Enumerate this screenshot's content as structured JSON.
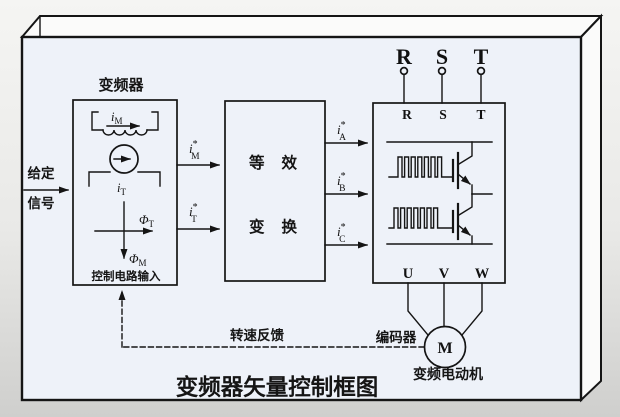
{
  "diagram_title": "变频器矢量控制框图",
  "colors": {
    "line": "#151515",
    "panel_fill": "#eef2f9",
    "face_fill": "#fbfbfa"
  },
  "input": {
    "line1": "给定",
    "line2": "信号"
  },
  "converter": {
    "label": "变频器",
    "footer": "控制电路输入",
    "flux_current": {
      "base": "i",
      "sub": "M"
    },
    "torque_current": {
      "base": "i",
      "sub": "T"
    },
    "flux_t": {
      "base": "Φ",
      "sub": "T"
    },
    "flux_m": {
      "base": "Φ",
      "sub": "M"
    }
  },
  "transform": {
    "line1": "等效",
    "line2": "变换"
  },
  "signals": {
    "im_ref": {
      "base": "i",
      "sup": "*",
      "sub": "M"
    },
    "it_ref": {
      "base": "i",
      "sup": "*",
      "sub": "T"
    },
    "ia_ref": {
      "base": "i",
      "sup": "*",
      "sub": "A"
    },
    "ib_ref": {
      "base": "i",
      "sup": "*",
      "sub": "B"
    },
    "ic_ref": {
      "base": "i",
      "sup": "*",
      "sub": "C"
    }
  },
  "supply": {
    "labels": [
      "R",
      "S",
      "T"
    ]
  },
  "inverter": {
    "rst": [
      "R",
      "S",
      "T"
    ],
    "uvw": [
      "U",
      "V",
      "W"
    ]
  },
  "feedback": {
    "speed_label": "转速反馈",
    "encoder_label": "编码器"
  },
  "motor": {
    "symbol": "M",
    "label": "变频电动机"
  }
}
